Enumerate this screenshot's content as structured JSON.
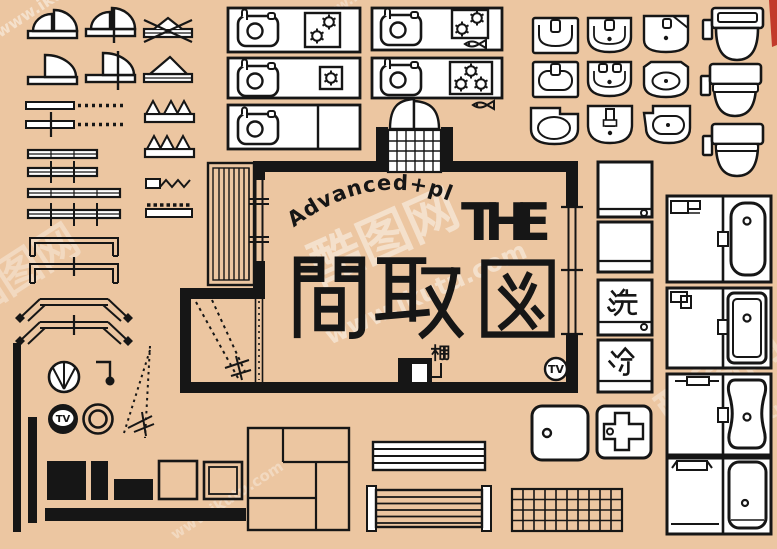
{
  "app": {
    "type": "floor-plan-symbol-sheet",
    "name": "THE 間取図"
  },
  "colors": {
    "background": "#ecc6a1",
    "ink": "#161616",
    "paper": "#ffffff",
    "watermark": "rgba(255,255,255,0.45)",
    "corner_mark": "#c23a2c"
  },
  "title": {
    "arc_text": "Advanced+plus",
    "main_en": "THE",
    "main_kanji": "間取図"
  },
  "floor_plan": {
    "shelf_label": "棚",
    "tv_label": "TV"
  },
  "appliance_labels": {
    "washer": "洗",
    "fridge": "冷"
  },
  "av_symbols": {
    "tv_label": "TV"
  },
  "watermarks": {
    "site_name_cn": "酷图网",
    "site_url": "www.ikutu.com"
  },
  "symbol_groups": [
    {
      "group": "doors-and-windows",
      "items": [
        "double-swing-door",
        "double-swing-door-with-mark",
        "louvered-vent-window",
        "single-swing-door",
        "single-swing-door-with-mark",
        "awning-window",
        "wall-opening-dotted",
        "wall-opening-dotted-with-mark",
        "accordion-door",
        "accordion-door-alt",
        "sliding-window",
        "sliding-window-with-marks",
        "folding-partition",
        "sliding-window-wide",
        "sliding-window-wide-with-marks",
        "dashed-threshold",
        "bay-window",
        "bay-window-with-mark",
        "angled-bay-window",
        "angled-bay-window-with-mark"
      ]
    },
    {
      "group": "kitchen-counters",
      "items": [
        "counter-sink-2-burner",
        "counter-sink-2-burner-fish-grill",
        "counter-sink-1-burner",
        "counter-sink-3-burner-fish-grill",
        "counter-sink-cabinet"
      ]
    },
    {
      "group": "entrance",
      "items": [
        "double-door-entry-tiled-step"
      ]
    },
    {
      "group": "washbasins",
      "items": [
        "washbasin-square",
        "washbasin-round-bowl",
        "washbasin-corner-cut",
        "washbasin-rounded-rect",
        "washbasin-two-taps",
        "washbasin-oval-bowl",
        "washbasin-offset-left",
        "washbasin-tall-tap",
        "washbasin-offset-right"
      ]
    },
    {
      "group": "toilets",
      "items": [
        "toilet-with-tank",
        "toilet-lid-open",
        "toilet-seat-band"
      ]
    },
    {
      "group": "appliances",
      "items": [
        "washing-machine",
        "cabinet",
        "washing-machine-labeled",
        "refrigerator-labeled"
      ]
    },
    {
      "group": "bathroom-units",
      "items": [
        "unit-bath-rounded-tub",
        "unit-bath-double-wall-tub",
        "unit-bath-contoured-tub",
        "unit-bath-wide-tub"
      ]
    },
    {
      "group": "living-symbols",
      "items": [
        "ceiling-fan",
        "pendant-light",
        "tv-round",
        "double-circle-stool",
        "stair-dash-marks",
        "black-table-large",
        "black-table-small",
        "black-bench",
        "table-square",
        "table-double-border",
        "sideboard-bar",
        "wall-post",
        "wall-post-short"
      ]
    },
    {
      "group": "floor-elements",
      "items": [
        "tatami-room",
        "slatted-mat",
        "slatted-bench",
        "shower-base",
        "cross-unit",
        "tiled-floor"
      ]
    }
  ]
}
